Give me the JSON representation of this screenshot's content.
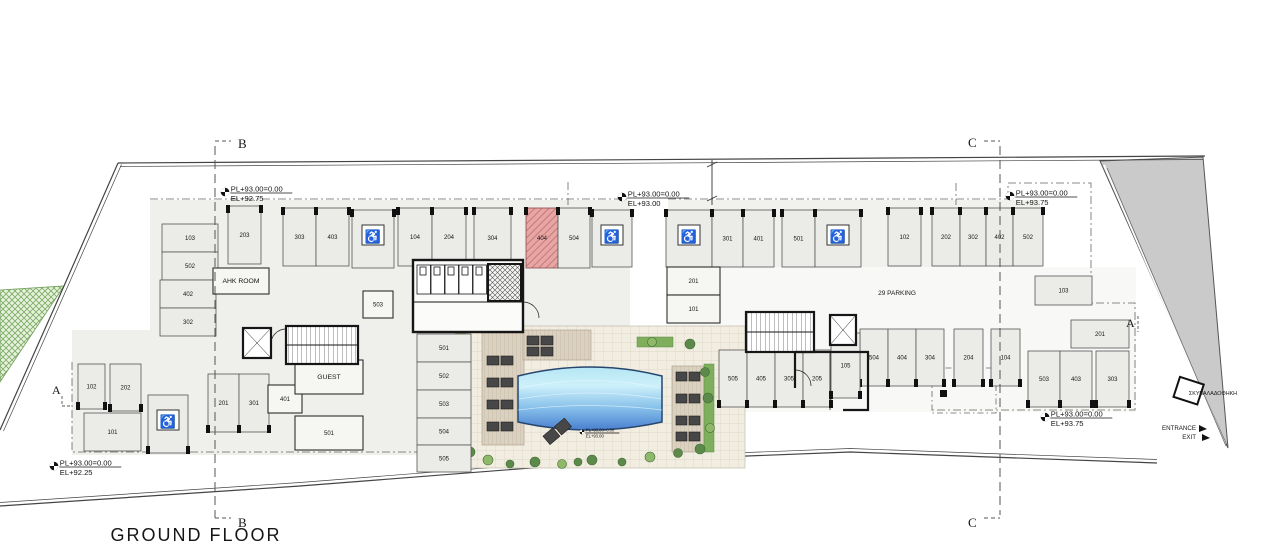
{
  "title": "GROUND FLOOR",
  "annotations": {
    "parking_count": "29 PARKING",
    "garbage_store": "ΣΚΥΒΑΛΑΔΟΘΗΚΗ",
    "entrance": "ENTRANCE",
    "exit": "EXIT"
  },
  "sections": {
    "a": "A",
    "b": "B",
    "c": "C"
  },
  "elevation_markers": [
    {
      "x": 225,
      "y": 192,
      "pl": "PL+93.00=0.00",
      "el": "EL+92.75",
      "small": false
    },
    {
      "x": 622,
      "y": 197,
      "pl": "PL+93.00=0.00",
      "el": "EL+93.00",
      "small": false
    },
    {
      "x": 1010,
      "y": 196,
      "pl": "PL+93.00=0.00",
      "el": "EL+93.75",
      "small": false
    },
    {
      "x": 1045,
      "y": 417,
      "pl": "PL+93.00=0.00",
      "el": "EL+93.75",
      "small": false
    },
    {
      "x": 54,
      "y": 466,
      "pl": "PL+93.00=0.00",
      "el": "EL+92.25",
      "small": false
    },
    {
      "x": 582,
      "y": 432,
      "pl": "PL+93.00=0.00",
      "el": "EL+93.00",
      "small": true
    }
  ],
  "parking_spaces": [
    {
      "label": "103",
      "x": 162,
      "y": 224,
      "w": 56,
      "h": 28,
      "t": "h"
    },
    {
      "label": "502",
      "x": 162,
      "y": 252,
      "w": 56,
      "h": 28,
      "t": "h"
    },
    {
      "label": "402",
      "x": 160,
      "y": 280,
      "w": 56,
      "h": 28,
      "t": "h"
    },
    {
      "label": "302",
      "x": 160,
      "y": 308,
      "w": 56,
      "h": 28,
      "t": "h"
    },
    {
      "label": "203",
      "x": 228,
      "y": 206,
      "w": 33,
      "h": 58,
      "t": "v"
    },
    {
      "label": "AHK ROOM",
      "x": 213,
      "y": 268,
      "w": 56,
      "h": 26,
      "t": "room"
    },
    {
      "label": "303",
      "x": 283,
      "y": 208,
      "w": 33,
      "h": 58,
      "t": "v"
    },
    {
      "label": "403",
      "x": 316,
      "y": 208,
      "w": 33,
      "h": 58,
      "t": "v"
    },
    {
      "label": "",
      "x": 352,
      "y": 210,
      "w": 42,
      "h": 58,
      "t": "hc"
    },
    {
      "label": "104",
      "x": 398,
      "y": 208,
      "w": 34,
      "h": 58,
      "t": "v"
    },
    {
      "label": "204",
      "x": 432,
      "y": 208,
      "w": 34,
      "h": 58,
      "t": "v"
    },
    {
      "label": "304",
      "x": 474,
      "y": 208,
      "w": 37,
      "h": 60,
      "t": "v"
    },
    {
      "label": "404",
      "x": 526,
      "y": 208,
      "w": 32,
      "h": 60,
      "t": "red"
    },
    {
      "label": "504",
      "x": 558,
      "y": 208,
      "w": 32,
      "h": 60,
      "t": "v"
    },
    {
      "label": "",
      "x": 592,
      "y": 210,
      "w": 40,
      "h": 57,
      "t": "hc"
    },
    {
      "label": "",
      "x": 666,
      "y": 210,
      "w": 46,
      "h": 57,
      "t": "hc"
    },
    {
      "label": "301",
      "x": 712,
      "y": 210,
      "w": 31,
      "h": 57,
      "t": "v"
    },
    {
      "label": "401",
      "x": 743,
      "y": 210,
      "w": 31,
      "h": 57,
      "t": "v"
    },
    {
      "label": "501",
      "x": 782,
      "y": 210,
      "w": 33,
      "h": 57,
      "t": "v"
    },
    {
      "label": "",
      "x": 815,
      "y": 210,
      "w": 46,
      "h": 57,
      "t": "hc"
    },
    {
      "label": "102",
      "x": 888,
      "y": 208,
      "w": 33,
      "h": 58,
      "t": "v"
    },
    {
      "label": "202",
      "x": 932,
      "y": 208,
      "w": 28,
      "h": 58,
      "t": "v"
    },
    {
      "label": "302",
      "x": 960,
      "y": 208,
      "w": 26,
      "h": 58,
      "t": "v"
    },
    {
      "label": "402",
      "x": 986,
      "y": 208,
      "w": 27,
      "h": 58,
      "t": "v"
    },
    {
      "label": "502",
      "x": 1013,
      "y": 208,
      "w": 30,
      "h": 58,
      "t": "v"
    },
    {
      "label": "103",
      "x": 1035,
      "y": 276,
      "w": 57,
      "h": 29,
      "t": "h"
    },
    {
      "label": "201",
      "x": 1071,
      "y": 320,
      "w": 58,
      "h": 28,
      "t": "h"
    },
    {
      "label": "503",
      "x": 1028,
      "y": 351,
      "w": 32,
      "h": 56,
      "t": "v"
    },
    {
      "label": "403",
      "x": 1060,
      "y": 351,
      "w": 32,
      "h": 56,
      "t": "v"
    },
    {
      "label": "303",
      "x": 1096,
      "y": 351,
      "w": 33,
      "h": 56,
      "t": "v"
    },
    {
      "label": "504",
      "x": 860,
      "y": 329,
      "w": 28,
      "h": 57,
      "t": "v"
    },
    {
      "label": "404",
      "x": 888,
      "y": 329,
      "w": 28,
      "h": 57,
      "t": "v"
    },
    {
      "label": "304",
      "x": 916,
      "y": 329,
      "w": 28,
      "h": 57,
      "t": "v"
    },
    {
      "label": "204",
      "x": 954,
      "y": 329,
      "w": 29,
      "h": 57,
      "t": "v"
    },
    {
      "label": "104",
      "x": 991,
      "y": 329,
      "w": 29,
      "h": 57,
      "t": "v"
    },
    {
      "label": "505",
      "x": 719,
      "y": 350,
      "w": 28,
      "h": 57,
      "t": "v"
    },
    {
      "label": "405",
      "x": 747,
      "y": 350,
      "w": 28,
      "h": 57,
      "t": "v"
    },
    {
      "label": "305",
      "x": 775,
      "y": 350,
      "w": 28,
      "h": 57,
      "t": "v"
    },
    {
      "label": "205",
      "x": 803,
      "y": 350,
      "w": 28,
      "h": 57,
      "t": "v"
    },
    {
      "label": "105",
      "x": 831,
      "y": 333,
      "w": 29,
      "h": 65,
      "t": "v"
    },
    {
      "label": "501",
      "x": 417,
      "y": 334,
      "w": 54,
      "h": 28,
      "t": "h"
    },
    {
      "label": "502",
      "x": 417,
      "y": 362,
      "w": 54,
      "h": 28,
      "t": "h"
    },
    {
      "label": "503",
      "x": 417,
      "y": 390,
      "w": 54,
      "h": 28,
      "t": "h"
    },
    {
      "label": "504",
      "x": 417,
      "y": 418,
      "w": 54,
      "h": 27,
      "t": "h"
    },
    {
      "label": "505",
      "x": 417,
      "y": 445,
      "w": 54,
      "h": 27,
      "t": "h"
    },
    {
      "label": "201",
      "x": 667,
      "y": 267,
      "w": 53,
      "h": 28,
      "t": "room"
    },
    {
      "label": "101",
      "x": 667,
      "y": 295,
      "w": 53,
      "h": 28,
      "t": "room"
    },
    {
      "label": "503",
      "x": 363,
      "y": 291,
      "w": 30,
      "h": 27,
      "t": "room"
    },
    {
      "label": "102",
      "x": 78,
      "y": 364,
      "w": 27,
      "h": 45,
      "t": "v"
    },
    {
      "label": "202",
      "x": 110,
      "y": 364,
      "w": 31,
      "h": 47,
      "t": "v"
    },
    {
      "label": "101",
      "x": 84,
      "y": 413,
      "w": 57,
      "h": 38,
      "t": "h"
    },
    {
      "label": "",
      "x": 148,
      "y": 395,
      "w": 40,
      "h": 58,
      "t": "hc"
    },
    {
      "label": "201",
      "x": 208,
      "y": 374,
      "w": 31,
      "h": 58,
      "t": "v"
    },
    {
      "label": "301",
      "x": 239,
      "y": 374,
      "w": 30,
      "h": 58,
      "t": "v"
    },
    {
      "label": "401",
      "x": 268,
      "y": 385,
      "w": 34,
      "h": 28,
      "t": "room"
    },
    {
      "label": "GUEST",
      "x": 295,
      "y": 360,
      "w": 68,
      "h": 34,
      "t": "room"
    },
    {
      "label": "501",
      "x": 295,
      "y": 416,
      "w": 68,
      "h": 34,
      "t": "room"
    }
  ],
  "colors": {
    "red_space": "#e7a6a4",
    "pool_top": "#c6ebf8",
    "pool_bottom": "#4a7fd0",
    "road": "#cacaca",
    "landscape_hatch": "#79ab62",
    "wood_deck": "#dbd1c0",
    "tile_deck": "#f2ede1"
  }
}
